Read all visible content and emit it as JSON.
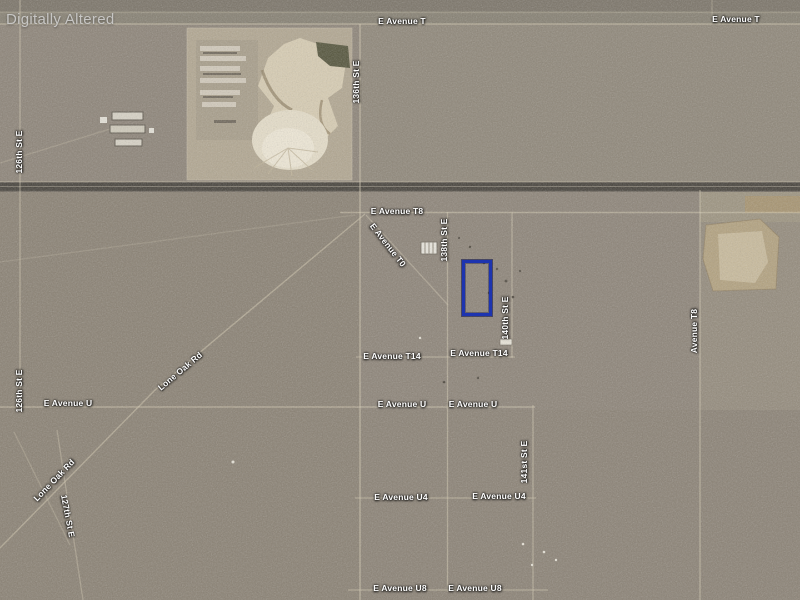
{
  "watermark": {
    "text": "Digitally Altered",
    "color": "#c7c6c4"
  },
  "map": {
    "type": "satellite-aerial",
    "label_color": "#ffffff",
    "road_labels": [
      {
        "text": "E Avenue T",
        "x": 402,
        "y": 21,
        "rot": 0
      },
      {
        "text": "E Avenue T",
        "x": 736,
        "y": 19,
        "rot": 0
      },
      {
        "text": "136th St E",
        "x": 356,
        "y": 82,
        "rot": -90
      },
      {
        "text": "126th St E",
        "x": 19,
        "y": 152,
        "rot": -90
      },
      {
        "text": "E Avenue T8",
        "x": 397,
        "y": 211,
        "rot": 0
      },
      {
        "text": "E Avenue T0",
        "x": 388,
        "y": 245,
        "rot": 52
      },
      {
        "text": "138th St E",
        "x": 444,
        "y": 240,
        "rot": -90
      },
      {
        "text": "140th St E",
        "x": 505,
        "y": 318,
        "rot": -90
      },
      {
        "text": "Avenue T8",
        "x": 694,
        "y": 331,
        "rot": -90
      },
      {
        "text": "E Avenue T14",
        "x": 392,
        "y": 356,
        "rot": 0
      },
      {
        "text": "E Avenue T14",
        "x": 479,
        "y": 353,
        "rot": 0
      },
      {
        "text": "Lone Oak Rd",
        "x": 180,
        "y": 371,
        "rot": -40
      },
      {
        "text": "126th St E",
        "x": 19,
        "y": 391,
        "rot": -90
      },
      {
        "text": "E Avenue U",
        "x": 68,
        "y": 403,
        "rot": 0
      },
      {
        "text": "E Avenue U",
        "x": 402,
        "y": 404,
        "rot": 0
      },
      {
        "text": "E Avenue U",
        "x": 473,
        "y": 404,
        "rot": 0
      },
      {
        "text": "Lone Oak Rd",
        "x": 54,
        "y": 480,
        "rot": -46
      },
      {
        "text": "127th St E",
        "x": 68,
        "y": 516,
        "rot": 79
      },
      {
        "text": "141st St E",
        "x": 524,
        "y": 462,
        "rot": -90
      },
      {
        "text": "E Avenue U4",
        "x": 401,
        "y": 497,
        "rot": 0
      },
      {
        "text": "E Avenue U4",
        "x": 499,
        "y": 496,
        "rot": 0
      },
      {
        "text": "E Avenue U8",
        "x": 400,
        "y": 588,
        "rot": 0
      },
      {
        "text": "E Avenue U8",
        "x": 475,
        "y": 588,
        "rot": 0
      }
    ],
    "parcel_outline": {
      "x": 462,
      "y": 260,
      "width": 24,
      "height": 50,
      "color": "#1d34b0"
    }
  }
}
